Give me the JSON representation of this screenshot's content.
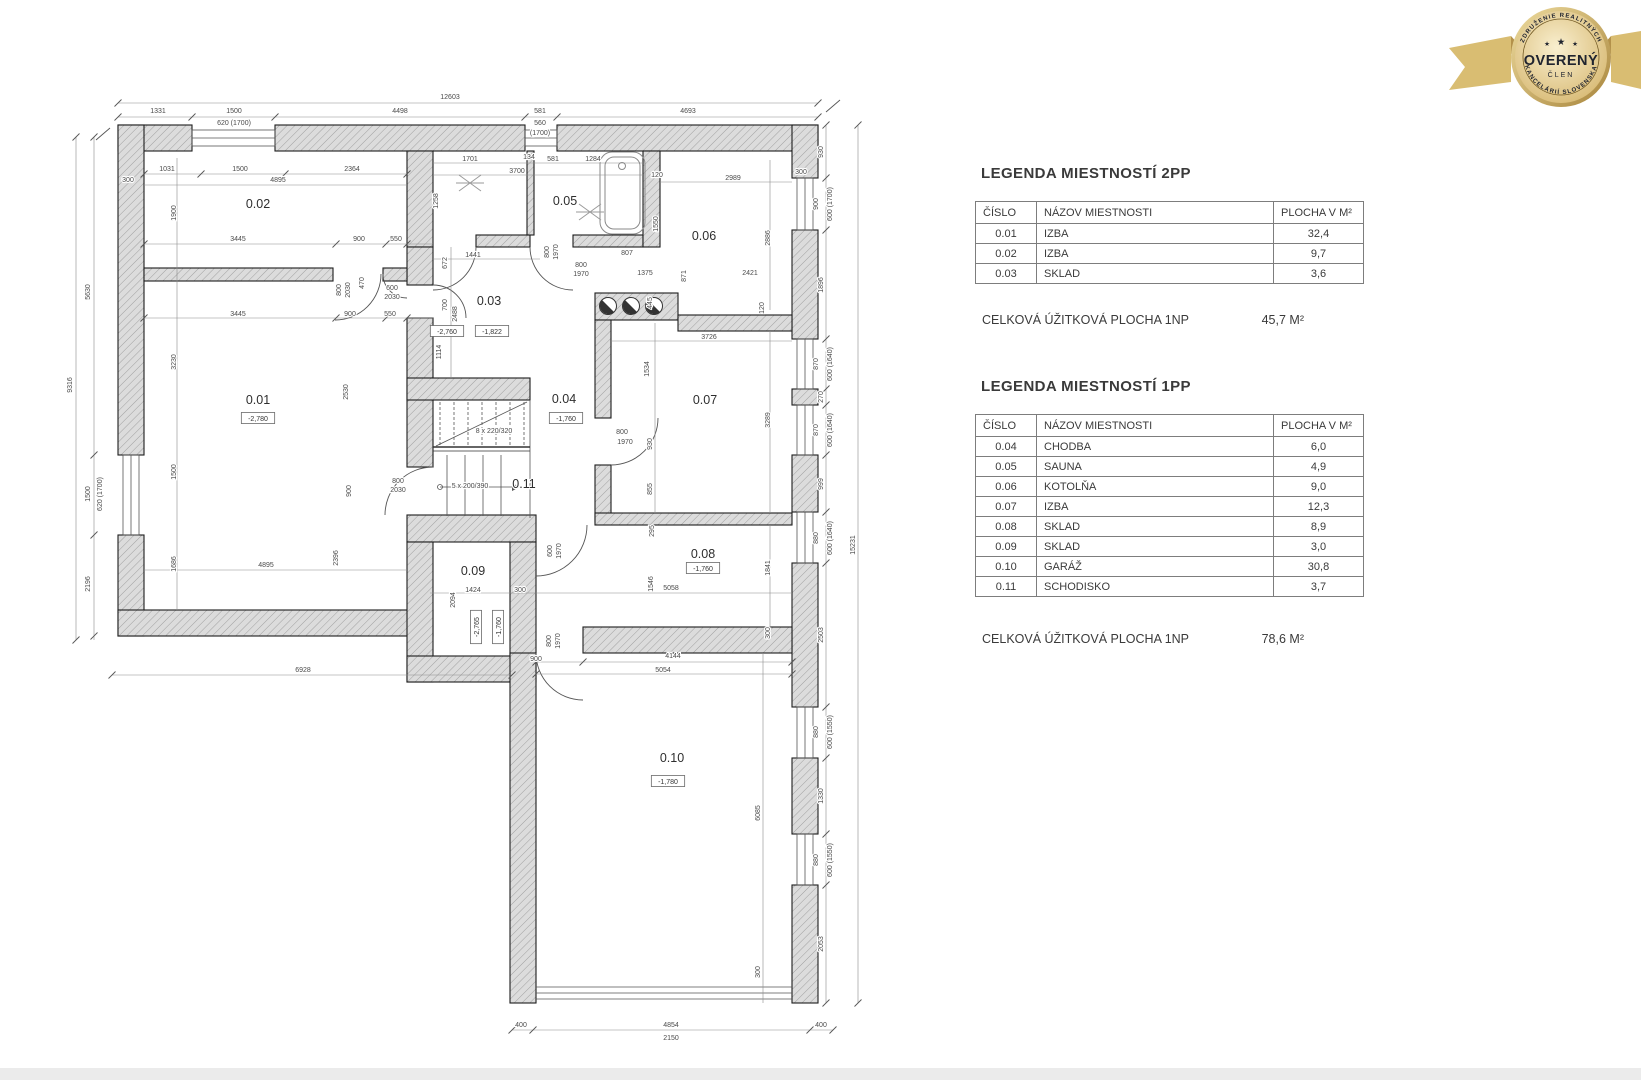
{
  "colors": {
    "wall_hatch": "#dcdcdc",
    "plan_line": "#1d1d1d",
    "dim_text": "#4a4a4a",
    "badge_gold": "#d9bd72",
    "badge_text": "#20242f"
  },
  "legend": {
    "s2": {
      "title": "LEGENDA MIESTNOSTÍ 2PP",
      "headers": [
        "ČÍSLO",
        "NÁZOV MIESTNOSTI",
        "PLOCHA V M²"
      ],
      "rows": [
        [
          "0.01",
          "IZBA",
          "32,4"
        ],
        [
          "0.02",
          "IZBA",
          "9,7"
        ],
        [
          "0.03",
          "SKLAD",
          "3,6"
        ]
      ],
      "total_label": "CELKOVÁ ÚŽITKOVÁ PLOCHA 1NP",
      "total_value": "45,7 M²"
    },
    "s1": {
      "title": "LEGENDA MIESTNOSTÍ 1PP",
      "headers": [
        "ČÍSLO",
        "NÁZOV MIESTNOSTI",
        "PLOCHA V M²"
      ],
      "rows": [
        [
          "0.04",
          "CHODBA",
          "6,0"
        ],
        [
          "0.05",
          "SAUNA",
          "4,9"
        ],
        [
          "0.06",
          "KOTOLŇA",
          "9,0"
        ],
        [
          "0.07",
          "IZBA",
          "12,3"
        ],
        [
          "0.08",
          "SKLAD",
          "8,9"
        ],
        [
          "0.09",
          "SKLAD",
          "3,0"
        ],
        [
          "0.10",
          "GARÁŽ",
          "30,8"
        ],
        [
          "0.11",
          "SCHODISKO",
          "3,7"
        ]
      ],
      "total_label": "CELKOVÁ ÚŽITKOVÁ PLOCHA 1NP",
      "total_value": "78,6 M²"
    }
  },
  "badge": {
    "arc_top": "ZDRUŽENIE REALITNÝCH",
    "center": "OVERENÝ",
    "sub": "ČLEN",
    "arc_bottom": "KANCELÁRIÍ SLOVENSKA",
    "star": "★"
  },
  "floorplan": {
    "room_labels": [
      {
        "t": "0.01",
        "x": 258,
        "y": 404
      },
      {
        "t": "0.02",
        "x": 258,
        "y": 208
      },
      {
        "t": "0.03",
        "x": 489,
        "y": 305
      },
      {
        "t": "0.04",
        "x": 564,
        "y": 403
      },
      {
        "t": "0.05",
        "x": 565,
        "y": 205
      },
      {
        "t": "0.06",
        "x": 704,
        "y": 240
      },
      {
        "t": "0.07",
        "x": 705,
        "y": 404
      },
      {
        "t": "0.08",
        "x": 703,
        "y": 558
      },
      {
        "t": "0.09",
        "x": 473,
        "y": 575
      },
      {
        "t": "0.10",
        "x": 672,
        "y": 762
      },
      {
        "t": "0.11",
        "x": 524,
        "y": 488
      }
    ],
    "elevations": [
      {
        "t": "-2,780",
        "x": 258,
        "y": 421
      },
      {
        "t": "-2,760",
        "x": 447,
        "y": 334
      },
      {
        "t": "-1,822",
        "x": 492,
        "y": 334
      },
      {
        "t": "-1,760",
        "x": 566,
        "y": 421
      },
      {
        "t": "-1,760",
        "x": 703,
        "y": 571
      },
      {
        "t": "-2,765",
        "x": 479,
        "y": 627,
        "r": 1
      },
      {
        "t": "-1,760",
        "x": 501,
        "y": 627,
        "r": 1
      },
      {
        "t": "-1,780",
        "x": 668,
        "y": 784
      }
    ],
    "dims": [
      {
        "t": "12603",
        "x": 450,
        "y": 99
      },
      {
        "t": "1331",
        "x": 158,
        "y": 113
      },
      {
        "t": "1500",
        "x": 234,
        "y": 113
      },
      {
        "t": "620 (1700)",
        "x": 234,
        "y": 125
      },
      {
        "t": "4498",
        "x": 400,
        "y": 113
      },
      {
        "t": "581",
        "x": 540,
        "y": 113
      },
      {
        "t": "560",
        "x": 540,
        "y": 125
      },
      {
        "t": "(1700)",
        "x": 540,
        "y": 135
      },
      {
        "t": "4693",
        "x": 688,
        "y": 113
      },
      {
        "t": "9316",
        "x": 72,
        "y": 385,
        "r": 1
      },
      {
        "t": "5630",
        "x": 90,
        "y": 292,
        "r": 1
      },
      {
        "t": "1500",
        "x": 90,
        "y": 494,
        "r": 1
      },
      {
        "t": "620 (1700)",
        "x": 102,
        "y": 494,
        "r": 1
      },
      {
        "t": "2196",
        "x": 90,
        "y": 584,
        "r": 1
      },
      {
        "t": "930",
        "x": 823,
        "y": 152,
        "r": 1
      },
      {
        "t": "900",
        "x": 818,
        "y": 204,
        "r": 1
      },
      {
        "t": "600 (1700)",
        "x": 832,
        "y": 204,
        "r": 1
      },
      {
        "t": "1896",
        "x": 823,
        "y": 285,
        "r": 1
      },
      {
        "t": "870",
        "x": 818,
        "y": 364,
        "r": 1
      },
      {
        "t": "600 (1640)",
        "x": 832,
        "y": 364,
        "r": 1
      },
      {
        "t": "270",
        "x": 823,
        "y": 397,
        "r": 1
      },
      {
        "t": "870",
        "x": 818,
        "y": 430,
        "r": 1
      },
      {
        "t": "600 (1640)",
        "x": 832,
        "y": 430,
        "r": 1
      },
      {
        "t": "999",
        "x": 823,
        "y": 484,
        "r": 1
      },
      {
        "t": "880",
        "x": 818,
        "y": 538,
        "r": 1
      },
      {
        "t": "600 (1640)",
        "x": 832,
        "y": 538,
        "r": 1
      },
      {
        "t": "2503",
        "x": 823,
        "y": 635,
        "r": 1
      },
      {
        "t": "880",
        "x": 818,
        "y": 732,
        "r": 1
      },
      {
        "t": "600 (1550)",
        "x": 832,
        "y": 732,
        "r": 1
      },
      {
        "t": "1330",
        "x": 823,
        "y": 796,
        "r": 1
      },
      {
        "t": "880",
        "x": 818,
        "y": 860,
        "r": 1
      },
      {
        "t": "600 (1550)",
        "x": 832,
        "y": 860,
        "r": 1
      },
      {
        "t": "2053",
        "x": 823,
        "y": 944,
        "r": 1
      },
      {
        "t": "15231",
        "x": 855,
        "y": 545,
        "r": 1
      },
      {
        "t": "300",
        "x": 801,
        "y": 174
      },
      {
        "t": "6928",
        "x": 303,
        "y": 672
      },
      {
        "t": "400",
        "x": 521,
        "y": 1027
      },
      {
        "t": "4854",
        "x": 671,
        "y": 1027
      },
      {
        "t": "2150",
        "x": 671,
        "y": 1040
      },
      {
        "t": "400",
        "x": 821,
        "y": 1027
      },
      {
        "t": "300",
        "x": 128,
        "y": 182
      },
      {
        "t": "1031",
        "x": 167,
        "y": 171
      },
      {
        "t": "1500",
        "x": 240,
        "y": 171
      },
      {
        "t": "2364",
        "x": 352,
        "y": 171
      },
      {
        "t": "4895",
        "x": 278,
        "y": 182
      },
      {
        "t": "1900",
        "x": 176,
        "y": 213,
        "r": 1
      },
      {
        "t": "3445",
        "x": 238,
        "y": 241
      },
      {
        "t": "900",
        "x": 359,
        "y": 241
      },
      {
        "t": "550",
        "x": 396,
        "y": 241
      },
      {
        "t": "3445",
        "x": 238,
        "y": 316
      },
      {
        "t": "900",
        "x": 350,
        "y": 316
      },
      {
        "t": "550",
        "x": 390,
        "y": 316
      },
      {
        "t": "3230",
        "x": 176,
        "y": 362,
        "r": 1
      },
      {
        "t": "2530",
        "x": 348,
        "y": 392,
        "r": 1
      },
      {
        "t": "1500",
        "x": 176,
        "y": 472,
        "r": 1
      },
      {
        "t": "1686",
        "x": 176,
        "y": 564,
        "r": 1
      },
      {
        "t": "4895",
        "x": 266,
        "y": 567
      },
      {
        "t": "2396",
        "x": 338,
        "y": 558,
        "r": 1
      },
      {
        "t": "800",
        "x": 341,
        "y": 290,
        "r": 1
      },
      {
        "t": "2030",
        "x": 350,
        "y": 290,
        "r": 1
      },
      {
        "t": "470",
        "x": 364,
        "y": 283,
        "r": 1
      },
      {
        "t": "600",
        "x": 392,
        "y": 290
      },
      {
        "t": "2030",
        "x": 392,
        "y": 299
      },
      {
        "t": "672",
        "x": 447,
        "y": 263,
        "r": 1
      },
      {
        "t": "1441",
        "x": 473,
        "y": 257
      },
      {
        "t": "700",
        "x": 447,
        "y": 305,
        "r": 1
      },
      {
        "t": "2488",
        "x": 457,
        "y": 314,
        "r": 1
      },
      {
        "t": "1114",
        "x": 441,
        "y": 352,
        "r": 1
      },
      {
        "t": "1701",
        "x": 470,
        "y": 161
      },
      {
        "t": "134",
        "x": 529,
        "y": 159
      },
      {
        "t": "581",
        "x": 553,
        "y": 161
      },
      {
        "t": "1284",
        "x": 593,
        "y": 161
      },
      {
        "t": "3700",
        "x": 517,
        "y": 173
      },
      {
        "t": "1258",
        "x": 438,
        "y": 201,
        "r": 1
      },
      {
        "t": "120",
        "x": 657,
        "y": 177
      },
      {
        "t": "2989",
        "x": 733,
        "y": 180
      },
      {
        "t": "1550",
        "x": 658,
        "y": 224,
        "r": 1
      },
      {
        "t": "2886",
        "x": 770,
        "y": 238,
        "r": 1
      },
      {
        "t": "800",
        "x": 549,
        "y": 252,
        "r": 1
      },
      {
        "t": "1970",
        "x": 558,
        "y": 252,
        "r": 1
      },
      {
        "t": "800",
        "x": 581,
        "y": 267
      },
      {
        "t": "1970",
        "x": 581,
        "y": 276
      },
      {
        "t": "807",
        "x": 627,
        "y": 255
      },
      {
        "t": "1375",
        "x": 645,
        "y": 275
      },
      {
        "t": "871",
        "x": 686,
        "y": 276,
        "r": 1
      },
      {
        "t": "2421",
        "x": 750,
        "y": 275
      },
      {
        "t": "445",
        "x": 652,
        "y": 303,
        "r": 1
      },
      {
        "t": "120",
        "x": 764,
        "y": 308,
        "r": 1
      },
      {
        "t": "3726",
        "x": 709,
        "y": 339
      },
      {
        "t": "1534",
        "x": 649,
        "y": 369,
        "r": 1
      },
      {
        "t": "3289",
        "x": 770,
        "y": 420,
        "r": 1
      },
      {
        "t": "800",
        "x": 622,
        "y": 434
      },
      {
        "t": "1970",
        "x": 625,
        "y": 444
      },
      {
        "t": "930",
        "x": 652,
        "y": 444,
        "r": 1
      },
      {
        "t": "855",
        "x": 652,
        "y": 489,
        "r": 1
      },
      {
        "t": "295",
        "x": 654,
        "y": 531,
        "r": 1
      },
      {
        "t": "5058",
        "x": 671,
        "y": 590
      },
      {
        "t": "1546",
        "x": 653,
        "y": 584,
        "r": 1
      },
      {
        "t": "1841",
        "x": 770,
        "y": 568,
        "r": 1
      },
      {
        "t": "300",
        "x": 770,
        "y": 633,
        "r": 1
      },
      {
        "t": "600",
        "x": 552,
        "y": 551,
        "r": 1
      },
      {
        "t": "1970",
        "x": 561,
        "y": 551,
        "r": 1
      },
      {
        "t": "8 x 220/320",
        "x": 494,
        "y": 433
      },
      {
        "t": "5 x 200/390",
        "x": 470,
        "y": 488
      },
      {
        "t": "800",
        "x": 398,
        "y": 483
      },
      {
        "t": "2030",
        "x": 398,
        "y": 492
      },
      {
        "t": "900",
        "x": 351,
        "y": 491,
        "r": 1
      },
      {
        "t": "1424",
        "x": 473,
        "y": 592
      },
      {
        "t": "2094",
        "x": 455,
        "y": 600,
        "r": 1
      },
      {
        "t": "300",
        "x": 520,
        "y": 592
      },
      {
        "t": "900",
        "x": 536,
        "y": 661
      },
      {
        "t": "4144",
        "x": 673,
        "y": 658
      },
      {
        "t": "5054",
        "x": 663,
        "y": 672
      },
      {
        "t": "800",
        "x": 551,
        "y": 641,
        "r": 1
      },
      {
        "t": "1970",
        "x": 560,
        "y": 641,
        "r": 1
      },
      {
        "t": "6085",
        "x": 760,
        "y": 813,
        "r": 1
      },
      {
        "t": "300",
        "x": 760,
        "y": 972,
        "r": 1
      }
    ]
  }
}
